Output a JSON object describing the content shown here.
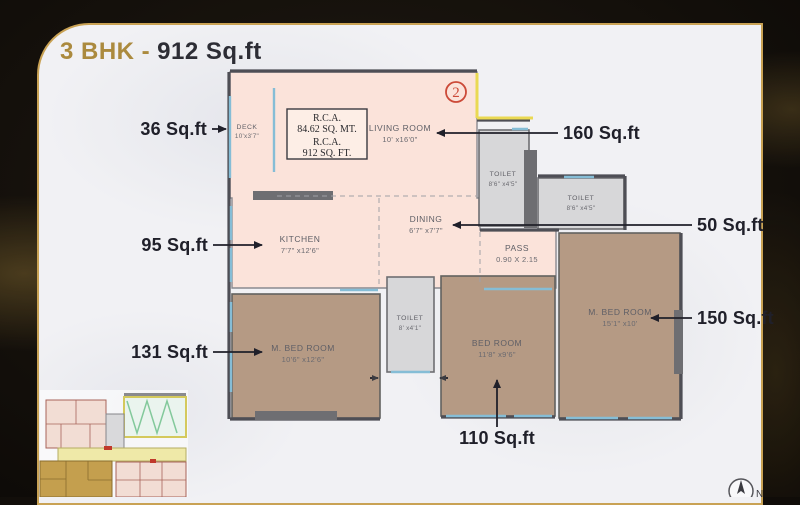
{
  "title": {
    "bhk": "3 BHK -",
    "area": "912 Sq.ft"
  },
  "plan": {
    "unit_number": "2",
    "rca": {
      "line1": "R.C.A.",
      "line2": "84.62 SQ. MT.",
      "line3": "R.C.A.",
      "line4": "912 SQ. FT."
    },
    "rooms": [
      {
        "name": "DECK",
        "dims": "10'x3'7\""
      },
      {
        "name": "LIVING ROOM",
        "dims": "10' x16'0\""
      },
      {
        "name": "KITCHEN",
        "dims": "7'7\" x12'6\""
      },
      {
        "name": "DINING",
        "dims": "6'7\" x7'7\""
      },
      {
        "name": "PASS",
        "dims": "0.90 X 2.15"
      },
      {
        "name": "TOILET",
        "dims": "8'6\" x4'5\""
      },
      {
        "name": "TOILET",
        "dims": "8'6\" x4'5\""
      },
      {
        "name": "TOILET",
        "dims": "8' x4'1\""
      },
      {
        "name": "M. BED ROOM",
        "dims": "10'6\" x12'6\""
      },
      {
        "name": "BED ROOM",
        "dims": "11'8\" x9'6\""
      },
      {
        "name": "M. BED ROOM",
        "dims": "15'1\" x10'"
      }
    ],
    "callouts": [
      {
        "label": "36 Sq.ft",
        "target": "deck"
      },
      {
        "label": "95 Sq.ft",
        "target": "kitchen"
      },
      {
        "label": "131 Sq.ft",
        "target": "master-bedroom-left"
      },
      {
        "label": "160 Sq.ft",
        "target": "living-room"
      },
      {
        "label": "50 Sq.ft",
        "target": "dining"
      },
      {
        "label": "150 Sq.ft",
        "target": "master-bedroom-right"
      },
      {
        "label": "110 Sq.ft",
        "target": "bedroom"
      }
    ],
    "compass": "N"
  },
  "colors": {
    "accent_gold": "#c9a254",
    "title_gold": "#ab8a3e",
    "title_dark": "#2d2d35",
    "room_pink": "#fbe3da",
    "room_tan": "#b59a84",
    "toilet_gray": "#d7d7d9",
    "duct_yellow": "#ead952",
    "unit_red": "#cc4a38",
    "label_gray": "#5f5f66",
    "callout_dark": "#20202a"
  }
}
